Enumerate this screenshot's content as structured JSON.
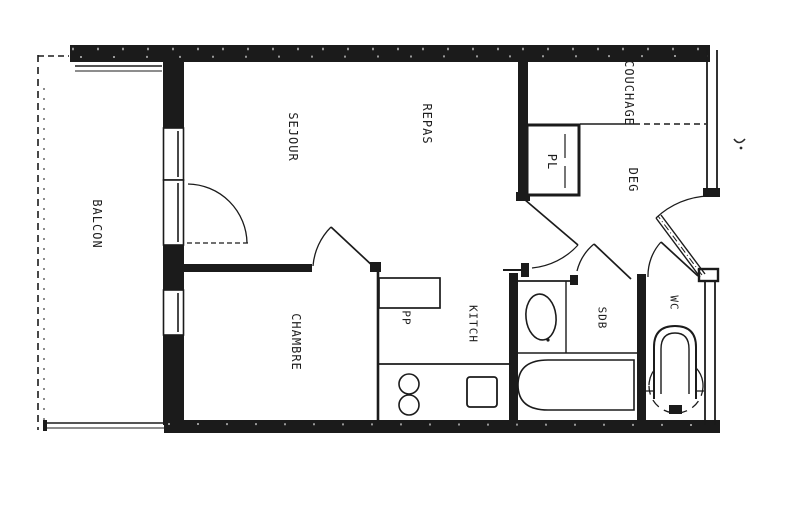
{
  "document": {
    "type": "apartment-floor-plan",
    "style": "scanned black-and-white architectural drawing"
  },
  "colors": {
    "ink": "#1b1b1b",
    "paper": "#ffffff"
  },
  "rooms": [
    {
      "id": "balcon",
      "label": "BALCON"
    },
    {
      "id": "sejour",
      "label": "SEJOUR"
    },
    {
      "id": "repas",
      "label": "REPAS"
    },
    {
      "id": "couchage",
      "label": "COUCHAGE"
    },
    {
      "id": "pl",
      "label": "PL"
    },
    {
      "id": "deg",
      "label": "DEG"
    },
    {
      "id": "chambre",
      "label": "CHAMBRE"
    },
    {
      "id": "pp",
      "label": "PP"
    },
    {
      "id": "kitch",
      "label": "KITCH"
    },
    {
      "id": "sdb",
      "label": "SDB"
    },
    {
      "id": "wc",
      "label": "WC"
    }
  ]
}
